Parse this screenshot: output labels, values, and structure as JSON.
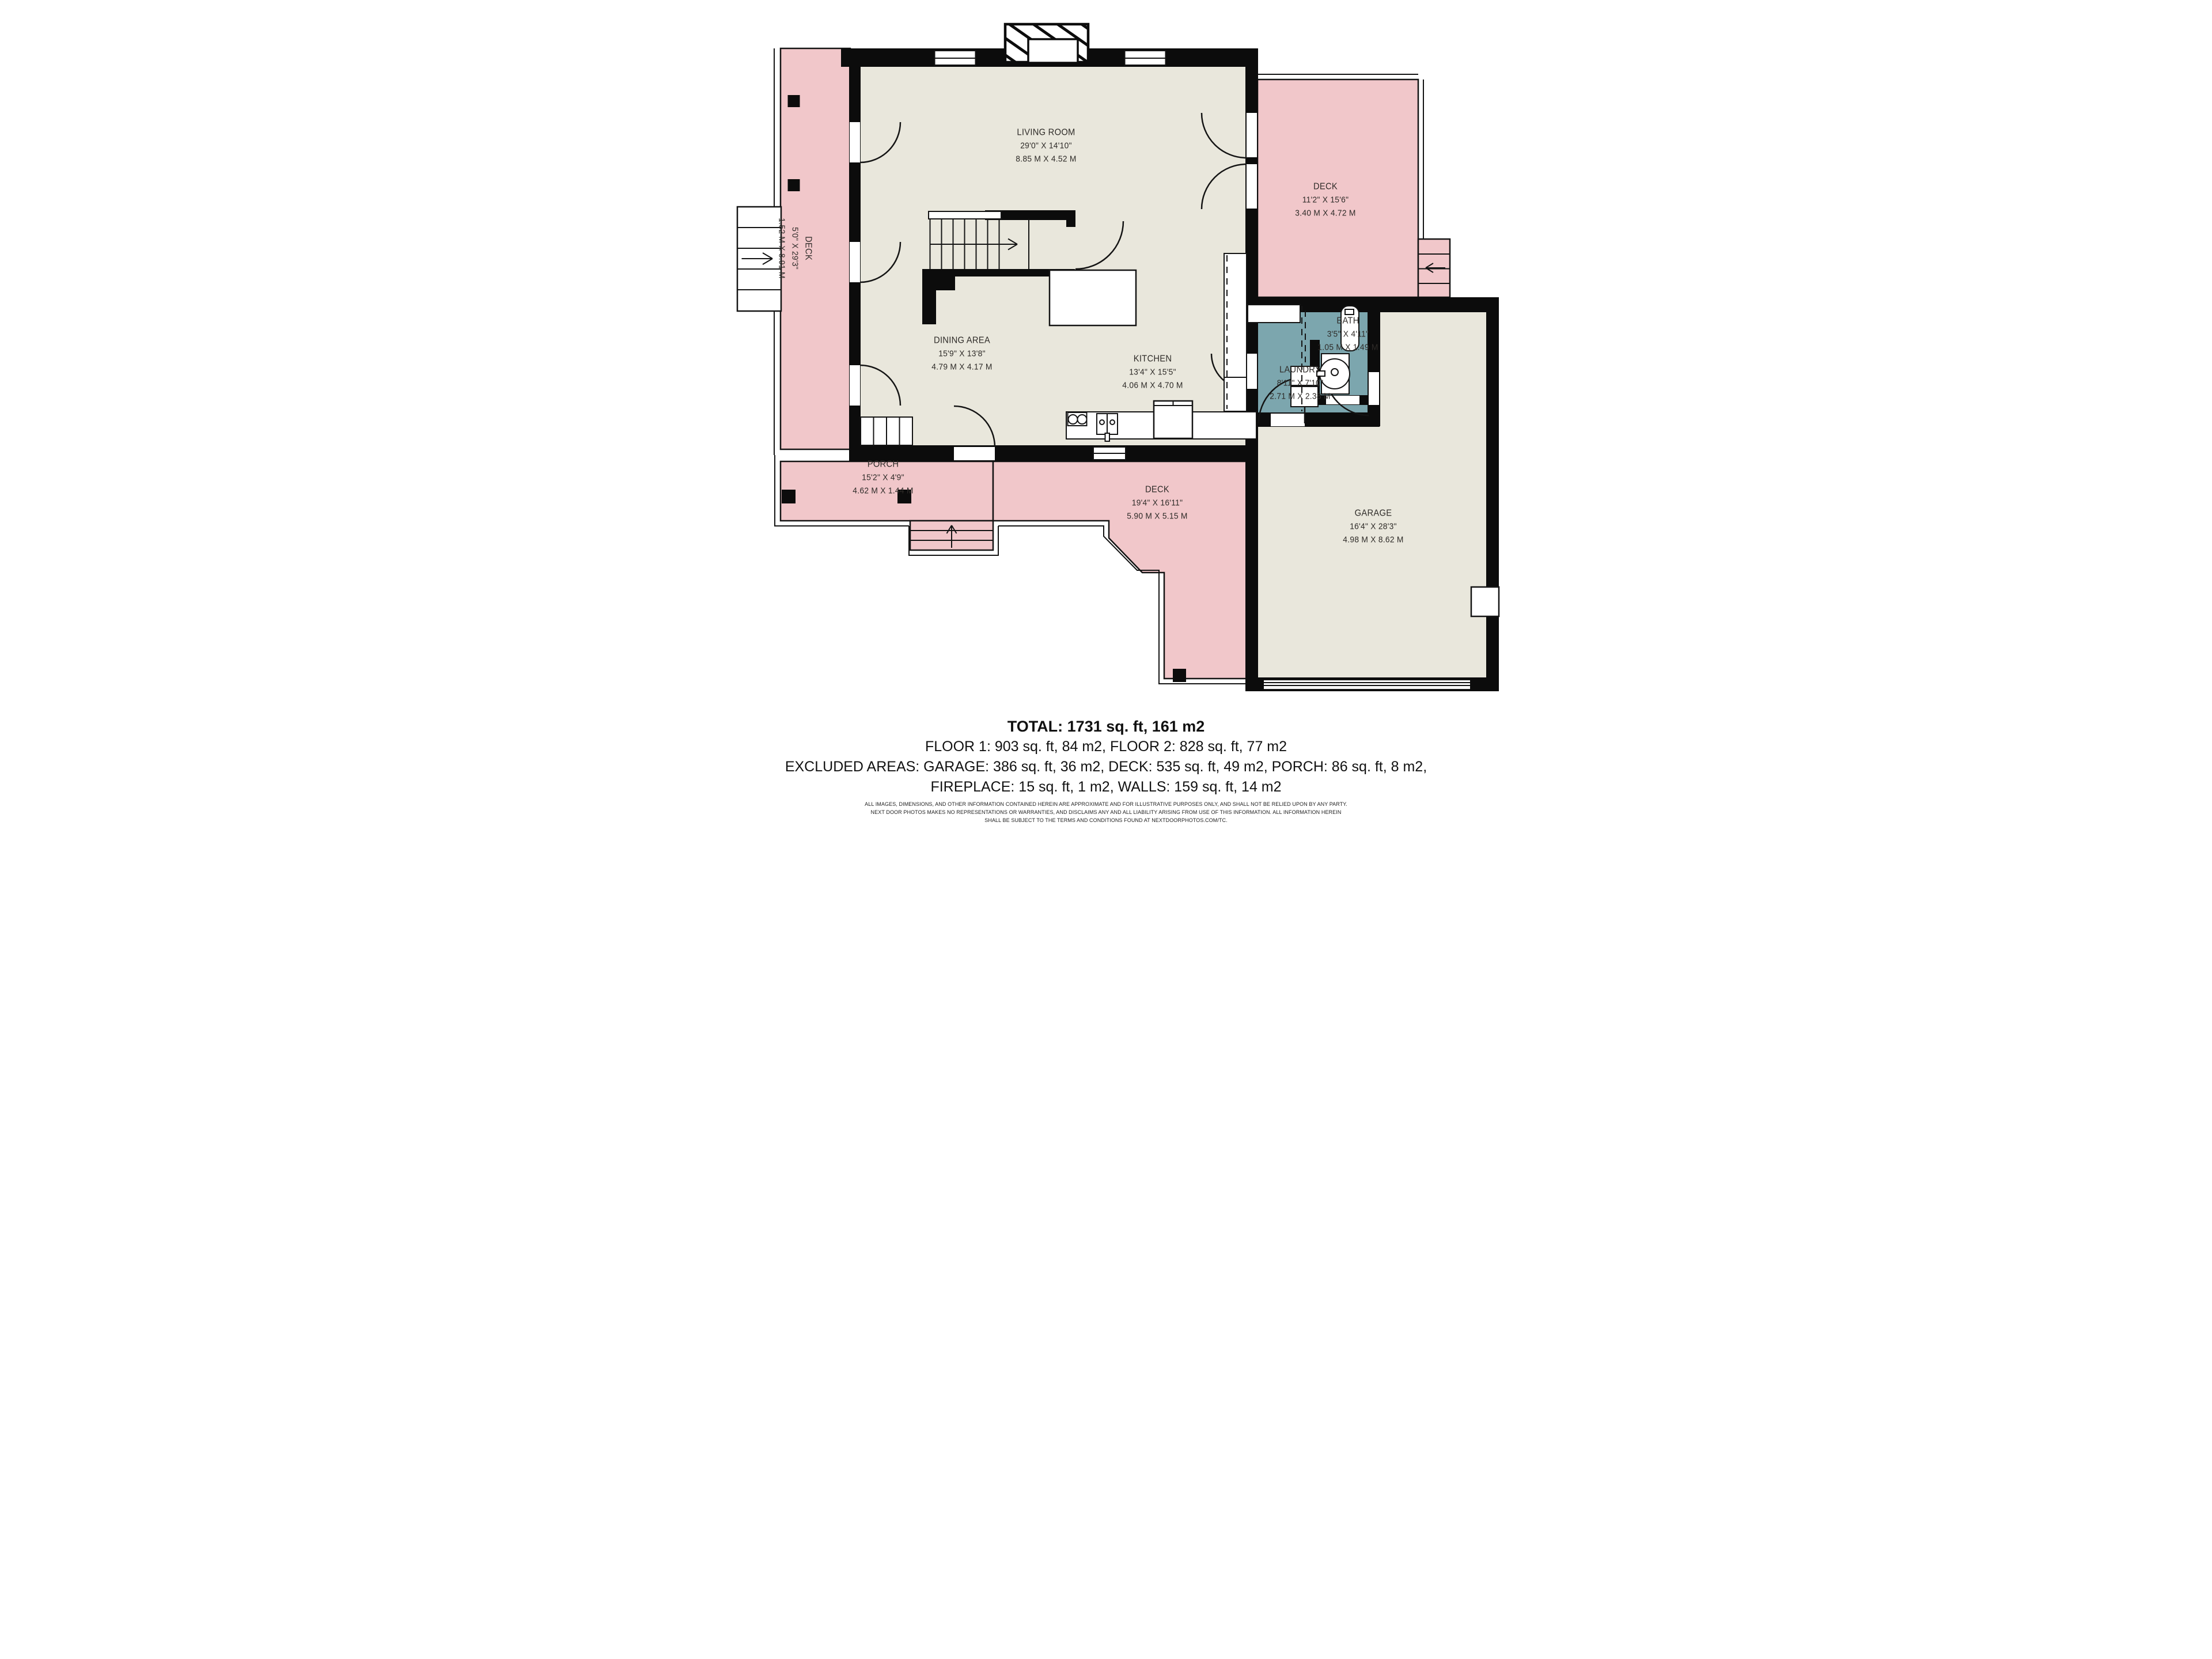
{
  "rooms": [
    {
      "name": "LIVING ROOM",
      "imperial": "29'0\" X 14'10\"",
      "metric": "8.85 M X 4.52 M"
    },
    {
      "name": "DECK",
      "imperial": "11'2\" X 15'6\"",
      "metric": "3.40 M X 4.72 M"
    },
    {
      "name": "DECK",
      "imperial": "5'0\" X 29'3\"",
      "metric": "1.52 M X 8.91 M"
    },
    {
      "name": "DINING AREA",
      "imperial": "15'9\" X 13'8\"",
      "metric": "4.79 M X 4.17 M"
    },
    {
      "name": "KITCHEN",
      "imperial": "13'4\" X 15'5\"",
      "metric": "4.06 M X 4.70 M"
    },
    {
      "name": "BATH",
      "imperial": "3'5\" X 4'11\"",
      "metric": "1.05 M X 1.49 M"
    },
    {
      "name": "LAUNDRY",
      "imperial": "8'11\" X 7'10\"",
      "metric": "2.71 M X 2.38 M"
    },
    {
      "name": "PORCH",
      "imperial": "15'2\" X 4'9\"",
      "metric": "4.62 M X 1.44 M"
    },
    {
      "name": "DECK",
      "imperial": "19'4\" X 16'11\"",
      "metric": "5.90 M X 5.15 M"
    },
    {
      "name": "GARAGE",
      "imperial": "16'4\" X 28'3\"",
      "metric": "4.98 M X 8.62 M"
    }
  ],
  "summary": {
    "total": "TOTAL: 1731 sq. ft, 161 m2",
    "floors": "FLOOR 1: 903 sq. ft, 84 m2, FLOOR 2: 828 sq. ft, 77 m2",
    "excluded_areas": "EXCLUDED AREAS: GARAGE: 386 sq. ft, 36 m2, DECK: 535 sq. ft, 49 m2, PORCH: 86 sq. ft, 8 m2,",
    "excluded_areas_2": "FIREPLACE: 15 sq. ft, 1 m2, WALLS: 159 sq. ft, 14 m2"
  },
  "disclaimer": {
    "line1": "ALL IMAGES, DIMENSIONS, AND OTHER INFORMATION CONTAINED HEREIN ARE APPROXIMATE AND FOR ILLUSTRATIVE PURPOSES ONLY, AND SHALL NOT BE RELIED UPON BY ANY PARTY.",
    "line2": "NEXT DOOR PHOTOS MAKES NO REPRESENTATIONS OR WARRANTIES, AND DISCLAIMS ANY AND ALL LIABILITY ARISING FROM USE OF THIS INFORMATION. ALL INFORMATION HEREIN",
    "line3": "SHALL BE SUBJECT TO THE TERMS AND CONDITIONS FOUND AT NEXTDOORPHOTOS.COM/TC."
  },
  "colors": {
    "deck_pink": "#f1c7ca",
    "floor_beige": "#e9e7dc",
    "wet_teal": "#7ca6ae",
    "wall_black": "#0c0c0c",
    "label_ink": "#2e2b28"
  }
}
